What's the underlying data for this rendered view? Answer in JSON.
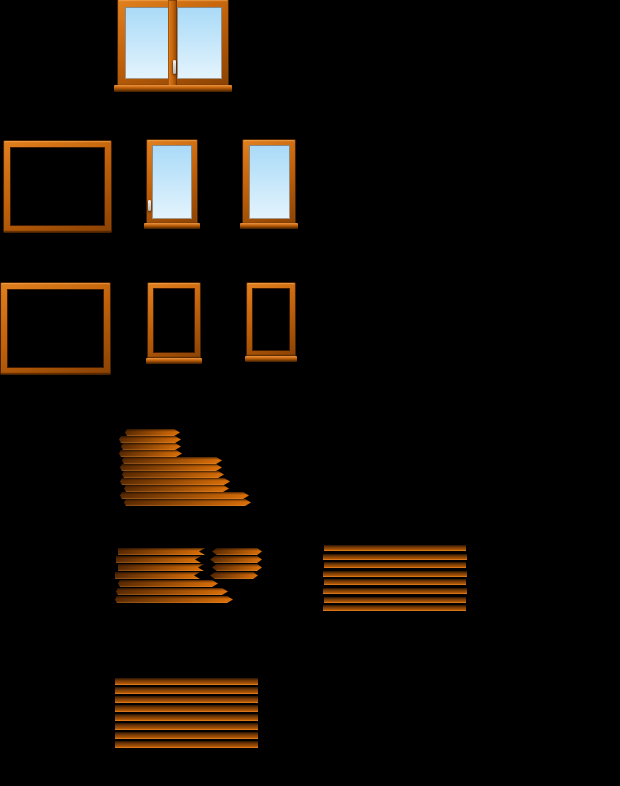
{
  "canvas": {
    "width": 620,
    "height": 786,
    "background": "#000000"
  },
  "palette": {
    "background": "#000000",
    "frame_light": "#e0801e",
    "frame_mid": "#c2620a",
    "frame_dark": "#8a4203",
    "frame_edge": "#4a2200",
    "sill_light": "#eb9440",
    "sill_dark": "#3c1c00",
    "glass_top": "#a9daf8",
    "glass_mid": "#c6e7fa",
    "glass_bottom": "#e4f4fd",
    "handle_light": "#f2f2f2",
    "handle_dark": "#b5b5b5",
    "plank_dark": "#582902",
    "plank_mid": "#a05006",
    "plank_bright": "#dc7008",
    "stack_top": "#271300",
    "stack_mid": "#7a3c05"
  },
  "windows": [
    {
      "id": "double-window",
      "name": "double-casement-window",
      "x": 114,
      "y": 0,
      "w": 118,
      "h": 92,
      "frame": {
        "x": 4,
        "y": 0,
        "w": 110,
        "h": 86,
        "t": 7
      },
      "glass": [
        {
          "x": 11,
          "y": 7,
          "w": 44,
          "h": 72
        },
        {
          "x": 63,
          "y": 7,
          "w": 45,
          "h": 72
        }
      ],
      "mullion": {
        "x": 54,
        "y": 0,
        "w": 9,
        "h": 86
      },
      "sill": {
        "x": 0,
        "y": 85,
        "w": 118,
        "h": 7
      },
      "handle": {
        "x": 59,
        "y": 60,
        "w": 3,
        "h": 14
      }
    },
    {
      "id": "frame-large-a",
      "name": "empty-window-frame-large-a",
      "x": 4,
      "y": 141,
      "w": 107,
      "h": 91,
      "frame": {
        "x": 0,
        "y": 0,
        "w": 107,
        "h": 91,
        "t": 6
      }
    },
    {
      "id": "window-single-a",
      "name": "single-casement-window-a",
      "x": 144,
      "y": 140,
      "w": 56,
      "h": 89,
      "frame": {
        "x": 3,
        "y": 0,
        "w": 50,
        "h": 84,
        "t": 5
      },
      "glass": [
        {
          "x": 8,
          "y": 5,
          "w": 40,
          "h": 74
        }
      ],
      "sill": {
        "x": 0,
        "y": 83,
        "w": 56,
        "h": 6
      },
      "handle": {
        "x": 4,
        "y": 60,
        "w": 3,
        "h": 11
      }
    },
    {
      "id": "window-single-b",
      "name": "single-casement-window-b",
      "x": 240,
      "y": 140,
      "w": 58,
      "h": 89,
      "frame": {
        "x": 3,
        "y": 0,
        "w": 52,
        "h": 84,
        "t": 5
      },
      "glass": [
        {
          "x": 9,
          "y": 5,
          "w": 41,
          "h": 74
        }
      ],
      "sill": {
        "x": 0,
        "y": 83,
        "w": 58,
        "h": 6
      }
    },
    {
      "id": "frame-large-b",
      "name": "empty-window-frame-large-b",
      "x": 1,
      "y": 283,
      "w": 109,
      "h": 91,
      "frame": {
        "x": 0,
        "y": 0,
        "w": 109,
        "h": 91,
        "t": 6
      }
    },
    {
      "id": "sash-empty-a",
      "name": "empty-sash-frame-a",
      "x": 146,
      "y": 282,
      "w": 56,
      "h": 82,
      "frame": {
        "x": 2,
        "y": 1,
        "w": 52,
        "h": 75,
        "t": 5
      },
      "sill": {
        "x": 0,
        "y": 76,
        "w": 56,
        "h": 6
      }
    },
    {
      "id": "sash-empty-b",
      "name": "empty-sash-frame-b",
      "x": 245,
      "y": 283,
      "w": 52,
      "h": 79,
      "frame": {
        "x": 2,
        "y": 0,
        "w": 48,
        "h": 73,
        "t": 5
      },
      "sill": {
        "x": 0,
        "y": 73,
        "w": 52,
        "h": 6
      }
    }
  ],
  "plank_piles": [
    {
      "id": "pile-stepped",
      "name": "stepped-plank-pile",
      "x": 115,
      "y": 429,
      "w": 134,
      "h": 77,
      "grad": "h",
      "end": "pointed",
      "planks": [
        [
          10,
          0,
          55,
          7
        ],
        [
          4,
          7,
          62,
          7
        ],
        [
          6,
          14,
          60,
          7
        ],
        [
          4,
          21,
          63,
          7
        ],
        [
          7,
          28,
          100,
          7
        ],
        [
          5,
          35,
          102,
          7
        ],
        [
          7,
          42,
          102,
          7
        ],
        [
          5,
          49,
          110,
          7
        ],
        [
          9,
          56,
          105,
          7
        ],
        [
          5,
          63,
          129,
          7
        ],
        [
          9,
          70,
          127,
          7
        ]
      ]
    },
    {
      "id": "pile-loose",
      "name": "loose-plank-pile",
      "x": 115,
      "y": 548,
      "w": 118,
      "h": 55,
      "grad": "h",
      "end": "notched",
      "planks": [
        [
          3,
          0,
          87,
          7
        ],
        [
          1,
          8,
          85,
          7
        ],
        [
          3,
          16,
          86,
          7
        ],
        [
          0,
          24,
          85,
          7
        ],
        [
          3,
          32,
          100,
          7,
          "pointed"
        ],
        [
          1,
          40,
          112,
          7,
          "pointed"
        ],
        [
          0,
          48,
          118,
          7,
          "pointed"
        ]
      ]
    },
    {
      "id": "pile-short",
      "name": "short-plank-group",
      "x": 210,
      "y": 548,
      "w": 52,
      "h": 31,
      "grad": "h",
      "end": "dpointed",
      "planks": [
        [
          2,
          0,
          50,
          7
        ],
        [
          0,
          8,
          52,
          7
        ],
        [
          2,
          16,
          50,
          7
        ],
        [
          0,
          24,
          48,
          7
        ]
      ]
    },
    {
      "id": "stack-right",
      "name": "plank-stack-right",
      "x": 323,
      "y": 545,
      "w": 144,
      "h": 66,
      "grad": "v",
      "end": "flat",
      "planks": [
        [
          1,
          0,
          142,
          6
        ],
        [
          0,
          9,
          144,
          6
        ],
        [
          1,
          17,
          142,
          6
        ],
        [
          0,
          26,
          144,
          6
        ],
        [
          1,
          34,
          142,
          6
        ],
        [
          0,
          43,
          144,
          6
        ],
        [
          1,
          52,
          142,
          6
        ],
        [
          0,
          60,
          143,
          6
        ]
      ]
    },
    {
      "id": "stack-bottom",
      "name": "plank-stack-bottom",
      "x": 115,
      "y": 678,
      "w": 143,
      "h": 70,
      "grad": "v",
      "end": "flat",
      "planks": [
        [
          0,
          0,
          143,
          7
        ],
        [
          0,
          9,
          143,
          7
        ],
        [
          0,
          18,
          143,
          7
        ],
        [
          0,
          27,
          143,
          7
        ],
        [
          0,
          36,
          143,
          7
        ],
        [
          0,
          45,
          143,
          7
        ],
        [
          0,
          54,
          143,
          7
        ],
        [
          0,
          63,
          143,
          7
        ]
      ]
    }
  ]
}
